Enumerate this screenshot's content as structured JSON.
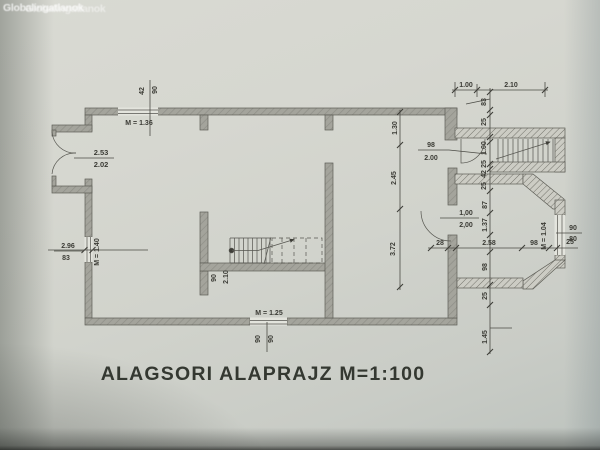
{
  "photo": {
    "watermark_a": "Globalingatlanok",
    "watermark_b": "Globalingatlanok"
  },
  "title": "ALAGSORI ALAPRAJZ M=1:100",
  "colors": {
    "paper": "#d4d5ce",
    "main_wall": "#a4a49c",
    "annex_wall": "#ccccc4",
    "ink": "#3b3b35"
  },
  "plan": {
    "top_window": {
      "dim_a": "42",
      "dim_b": "90",
      "label": "M = 1.36"
    },
    "entry_door": {
      "width": "2.53",
      "height": "2.02"
    },
    "left_window": {
      "width": "2.96",
      "sill": "83",
      "label": "M = 1.40"
    },
    "bottom_window": {
      "label": "M = 1.25",
      "dim_a": "90",
      "dim_b": "90"
    },
    "interior_door": {
      "width": "90",
      "height": "2.10"
    },
    "stair_door": {
      "width": "98",
      "height": "2.00"
    },
    "bay_door": {
      "width": "1,00",
      "height": "2,00"
    },
    "bay_window": {
      "label": "M = 1.04",
      "dim_a": "90",
      "dim_b": "80"
    },
    "top_dims": [
      "1.00",
      "2.10"
    ],
    "left_chain": [
      "1.30",
      "2.45",
      "3.72"
    ],
    "right_chain": [
      "83",
      "25",
      "1.00",
      "25",
      "42",
      "25",
      "87",
      "1.37",
      "98",
      "25",
      "1.45"
    ],
    "bay_chain": [
      "28",
      "2.58",
      "98",
      "25"
    ]
  }
}
